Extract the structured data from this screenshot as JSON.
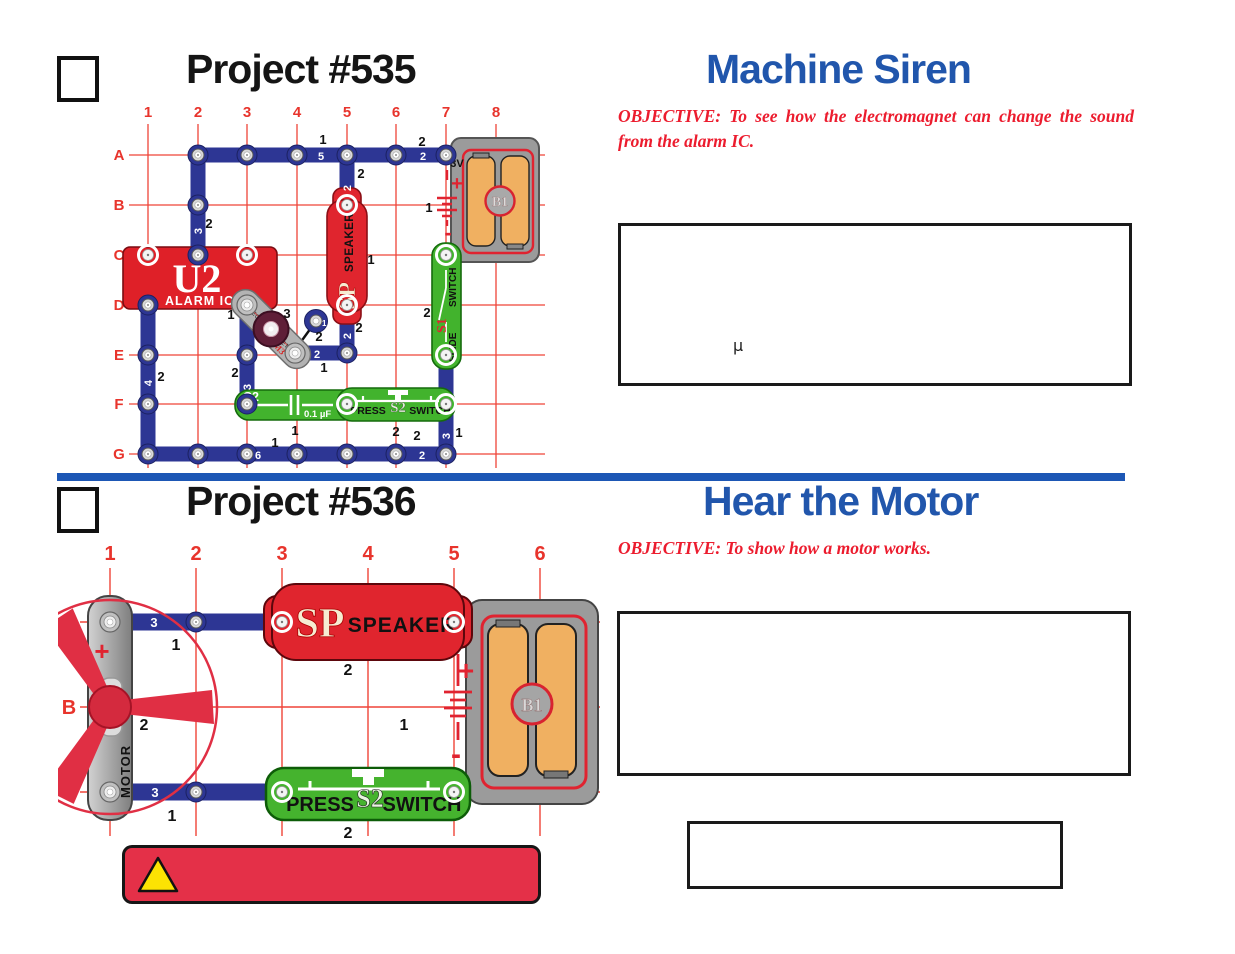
{
  "p535": {
    "project": "Project #535",
    "title": "Machine Siren",
    "objective": "OBJECTIVE:   To see how the electromagnet can change the sound from the alarm IC.",
    "note_mu": "µ",
    "grid": {
      "cols": [
        "1",
        "2",
        "3",
        "4",
        "5",
        "6",
        "7",
        "8"
      ],
      "rows": [
        "A",
        "B",
        "C",
        "D",
        "E",
        "F",
        "G"
      ]
    },
    "parts": {
      "u2": {
        "id": "U2",
        "name": "ALARM IC"
      },
      "sp": {
        "id": "SP",
        "name": "SPEAKER"
      },
      "s1": {
        "id": "S1",
        "line1": "SLIDE",
        "line2": "SWITCH"
      },
      "s2": {
        "id": "S2",
        "left": "PRESS",
        "right": "SWITCH"
      },
      "c2": {
        "id": "C2",
        "value": "0.1 µF"
      },
      "b1": {
        "id": "B1",
        "volt": "3V",
        "plus": "+",
        "minus": "-"
      },
      "m3": {
        "id": "M3",
        "name": "ELECTROMAGNET"
      }
    },
    "wire": {
      "rowA": "5",
      "rowA_right": "2",
      "col2": "3",
      "col5_top": "2",
      "col1": "4",
      "col3": "3",
      "col5_mid": "2",
      "rowE": "2",
      "snap1": "1",
      "rowG": "6",
      "rowG_right": "2",
      "col7": "3"
    },
    "layer": {
      "rowA_mid": "1",
      "rowA_right": "2",
      "col2": "2",
      "col5_top": "2",
      "speaker": "1",
      "u2": "1",
      "m3": "3",
      "snap1": "2",
      "col5_mid": "2",
      "rowE": "1",
      "col1": "2",
      "col3": "2",
      "battery": "1",
      "s1": "2",
      "c2": "1",
      "s2": "2",
      "col7": "1",
      "rowG_mid": "1",
      "rowG_right": "2"
    }
  },
  "p536": {
    "project": "Project #536",
    "title": "Hear the Motor",
    "objective": "OBJECTIVE:  To show how a motor works.",
    "grid": {
      "cols": [
        "1",
        "2",
        "3",
        "4",
        "5",
        "6"
      ],
      "row": "B"
    },
    "parts": {
      "motor": {
        "name": "MOTOR",
        "plus": "+"
      },
      "sp": {
        "id": "SP",
        "name": "SPEAKER"
      },
      "s2": {
        "id": "S2",
        "left": "PRESS",
        "right": "SWITCH"
      },
      "b1": {
        "id": "B1",
        "volt": "3V",
        "plus": "+",
        "minus": "-"
      }
    },
    "wire": {
      "top": "3",
      "bottom": "3"
    },
    "layer": {
      "top": "1",
      "bottom": "1",
      "speaker": "2",
      "motor": "2",
      "battery": "1",
      "s2": "2"
    }
  }
}
